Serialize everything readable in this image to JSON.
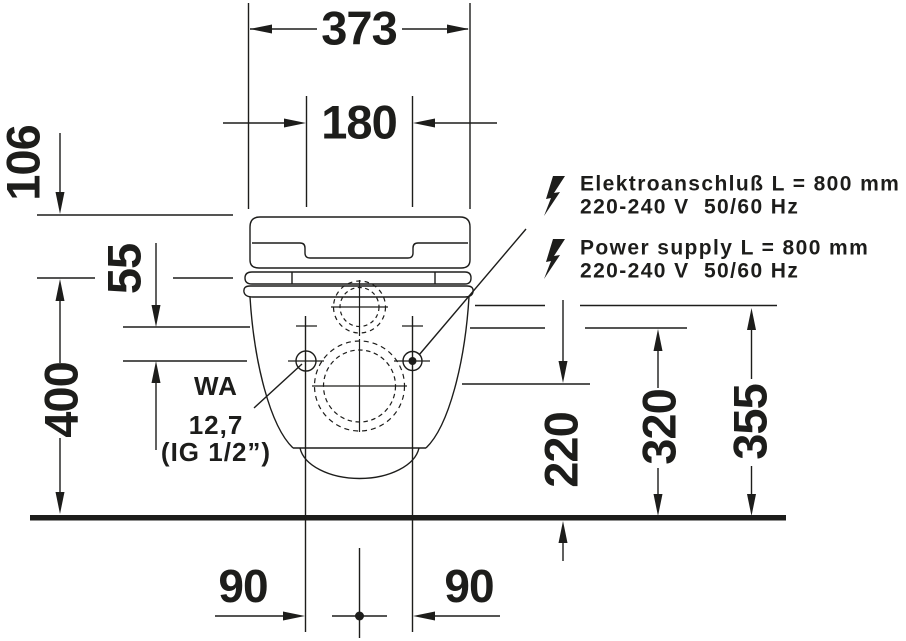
{
  "drawing_title": "wall-hung-shower-toilet-front-elevation",
  "colors": {
    "line": "#1d1d1b",
    "background": "#ffffff"
  },
  "dimensions": {
    "overall_width": "373",
    "fixing_width": "180",
    "seat_height": "106",
    "fixing_offset": "55",
    "rim_height": "400",
    "outlet_height": "220",
    "fixing_height": "320",
    "connection_height": "355",
    "offset_left": "90",
    "offset_right": "90"
  },
  "water_connection": {
    "code": "WA",
    "size": "12,7",
    "thread": "(IG 1/2”)"
  },
  "electrical_de": {
    "line1": "Elektroanschluß L = 800 mm",
    "line2": "220-240 V  50/60 Hz"
  },
  "electrical_en": {
    "line1": "Power supply L = 800 mm",
    "line2": "220-240 V  50/60 Hz"
  }
}
